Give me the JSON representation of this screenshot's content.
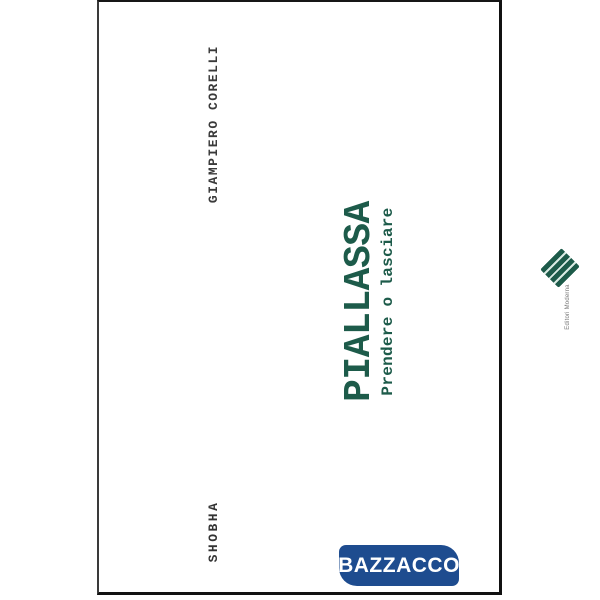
{
  "image": {
    "background_color": "#ffffff",
    "description": "book cover rotated 90 degrees counter-clockwise"
  },
  "book_cover": {
    "author": "GIAMPIERO CORELLI",
    "title": "PIALLASSA",
    "subtitle": "Prendere o lasciare",
    "photographer_credit": "SHOBHA",
    "publisher": {
      "name": "Editori Moderna",
      "logo_icon": "green-striped-diamond"
    },
    "colors": {
      "title_text": "#1d5b4a",
      "credit_text": "#3a3a3a",
      "cover_border": "#111111",
      "cover_background": "#ffffff"
    }
  },
  "watermark_badge": {
    "label": "BAZZACCO",
    "background_color": "#1e4c8f",
    "text_color": "#ffffff"
  }
}
